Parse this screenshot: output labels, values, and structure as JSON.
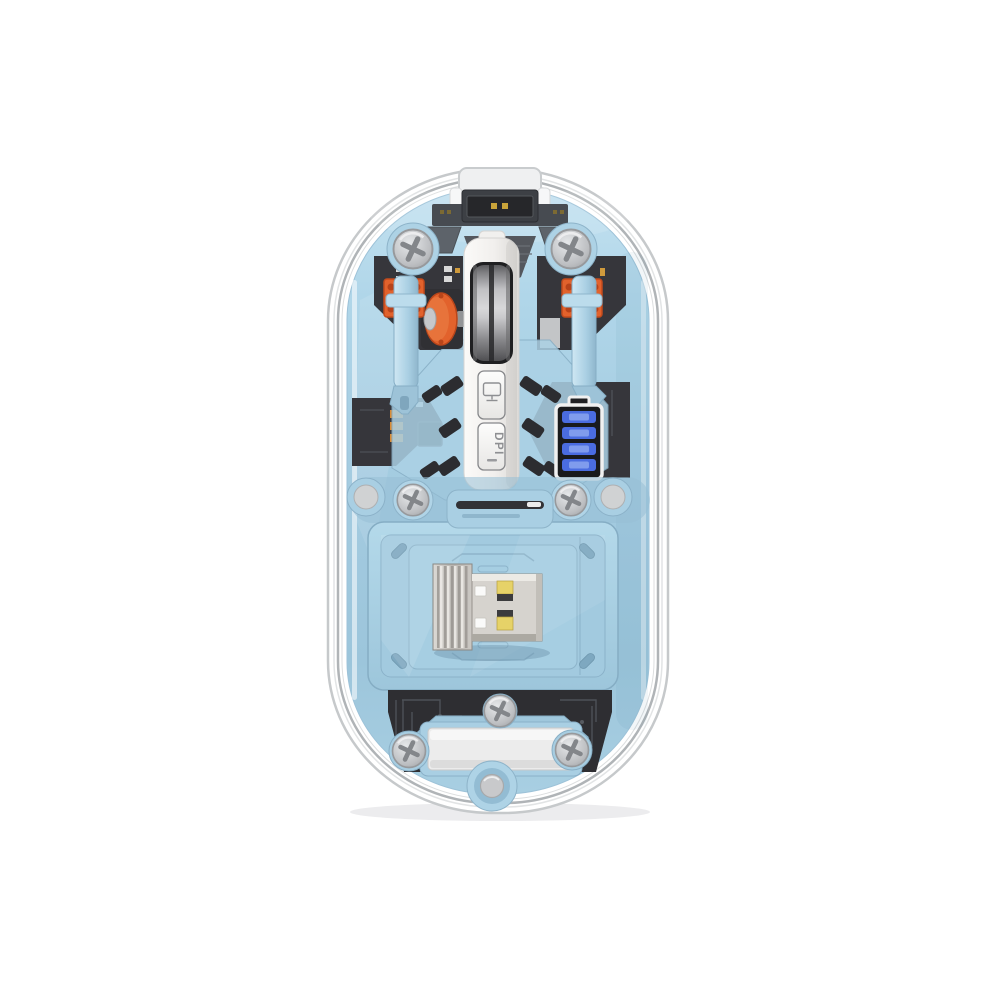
{
  "meta": {
    "type": "product-photo",
    "subject": "Transparent wireless mouse, top-down view of internal components",
    "background": "#ffffff"
  },
  "labels": {
    "dpi_button": "DPI"
  },
  "battery": {
    "segments": 4
  },
  "colors": {
    "accent_orange": "#e2622c",
    "accent_orange_dark": "#c24a1c",
    "led_blue": "#4a6ce0",
    "led_blue_light": "#8aa4ee",
    "usb_gold": "#e6d268",
    "body_blue": "#a5cce1",
    "body_blue_light": "#c3e1f0",
    "pcb_dark": "#36363b",
    "housing_white": "#f2f1ef",
    "shell_gray": "#b0b4b7",
    "gold_contact": "#c9a43a"
  },
  "parts": {
    "list": [
      "charging-port",
      "port-cap",
      "left-click-switch",
      "right-click-switch",
      "scroll-wheel",
      "wheel-encoder",
      "display-mode-button",
      "dpi-button",
      "battery-indicator",
      "usb-receiver-dongle",
      "receiver-compartment",
      "chassis-screws",
      "product-label",
      "bottom-round-button"
    ]
  }
}
